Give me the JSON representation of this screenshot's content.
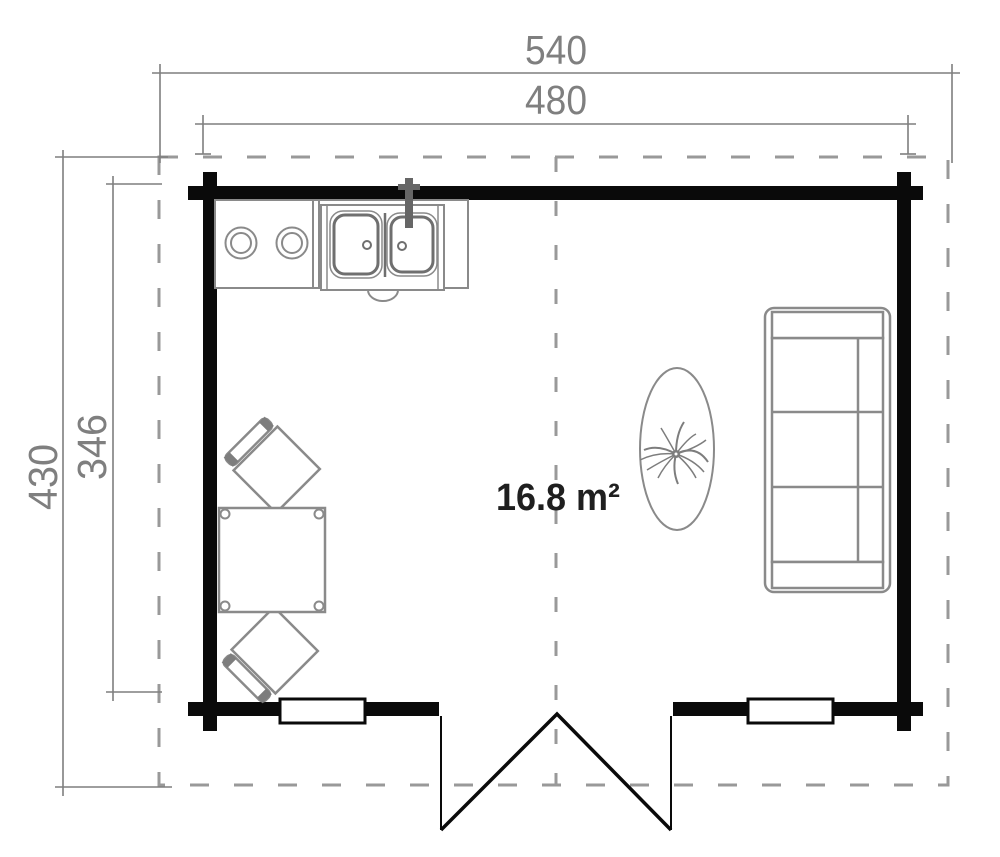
{
  "drawing": {
    "type": "floor-plan",
    "area_label": "16.8 m²",
    "dimensions": {
      "top_outer": "540",
      "top_inner": "480",
      "left_outer": "430",
      "left_inner": "346"
    },
    "symbols": [
      "stove-two-burners",
      "double-sink-with-faucet",
      "dining-table",
      "chair-rotated",
      "chair-rotated",
      "three-seat-sofa",
      "plant-on-oval-table",
      "double-door",
      "window-left",
      "window-right"
    ],
    "colors": {
      "walls": "#0a0a0a",
      "furniture_lines": "#8a8a8a",
      "dimension_lines": "#7f7f7f",
      "dashed_overhang": "#999999",
      "area_text": "#1f1f1f",
      "background": "#ffffff"
    }
  }
}
